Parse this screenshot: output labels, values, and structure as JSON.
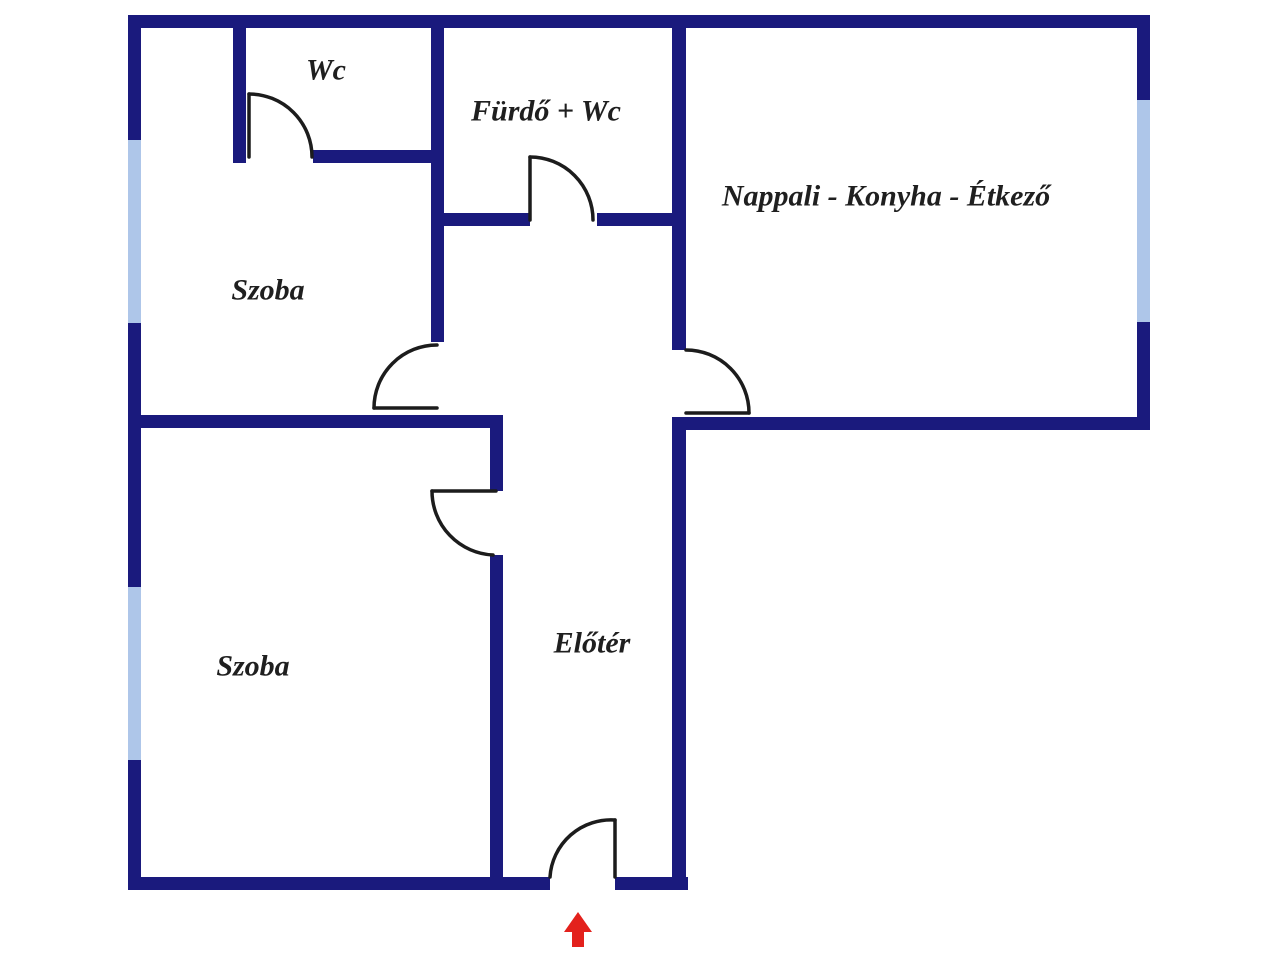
{
  "plan": {
    "rooms": [
      {
        "id": "wc",
        "label": "Wc"
      },
      {
        "id": "furdo-wc",
        "label": "Fürdő + Wc"
      },
      {
        "id": "nappali",
        "label": "Nappali - Konyha - Étkező"
      },
      {
        "id": "szoba-upper",
        "label": "Szoba"
      },
      {
        "id": "szoba-lower",
        "label": "Szoba"
      },
      {
        "id": "eloter",
        "label": "Előtér"
      }
    ],
    "entrance_marker": "red-up-arrow"
  },
  "colors": {
    "wall": "#1a1a7d",
    "window": "#aec6e9",
    "door": "#1c1c1c",
    "entrance_arrow": "#e3211c",
    "label": "#1f1f1f",
    "background": "#ffffff"
  }
}
